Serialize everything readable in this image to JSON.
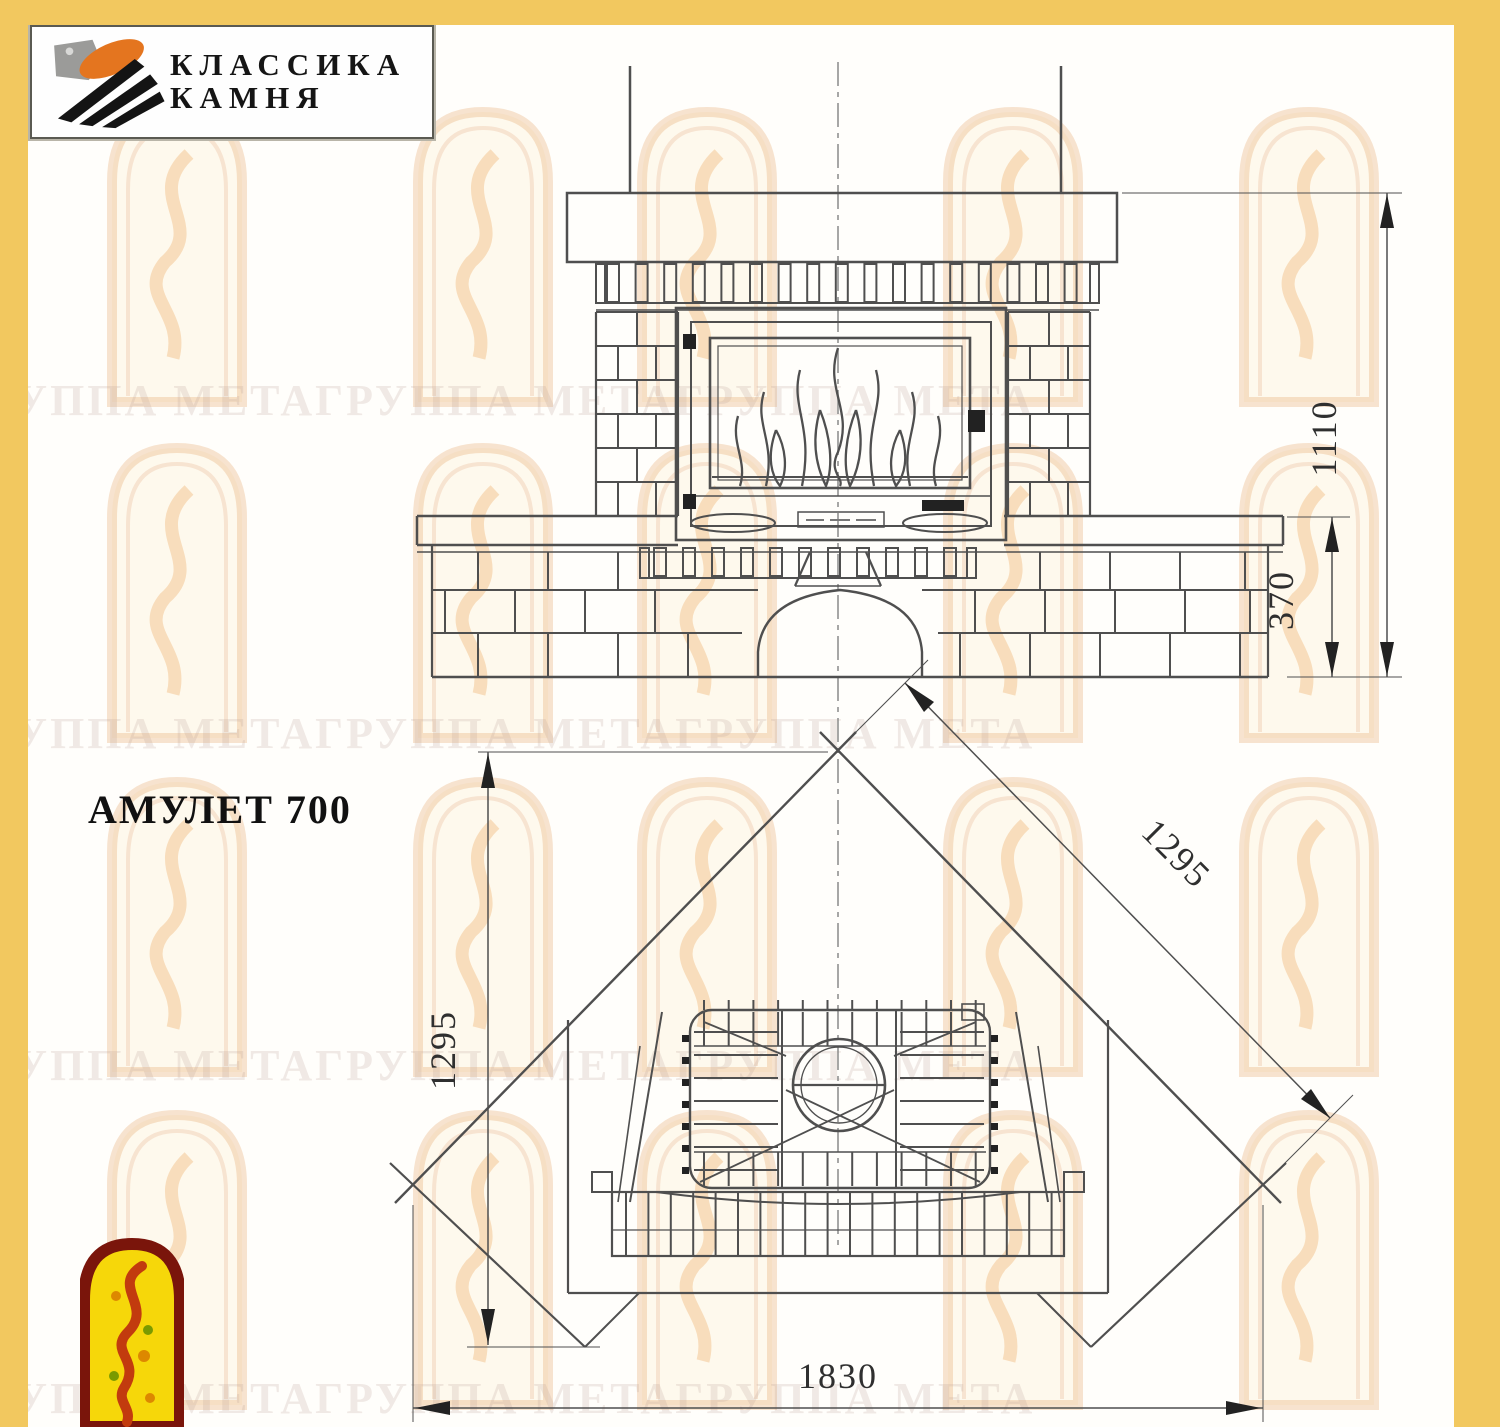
{
  "frame": {
    "color": "#F2C85F"
  },
  "brand": {
    "name_line1": "КЛАССИКА",
    "name_line2": "КАМНЯ"
  },
  "product": {
    "title": "АМУЛЕТ 700"
  },
  "watermark": {
    "text": "ГРУППА МЕТАГРУППА МЕТАГРУППА МЕТА"
  },
  "dimensions": {
    "front_total_height": "1110",
    "front_bench_height": "370",
    "plan_depth": "1295",
    "plan_wall": "1295",
    "plan_width": "1830"
  }
}
